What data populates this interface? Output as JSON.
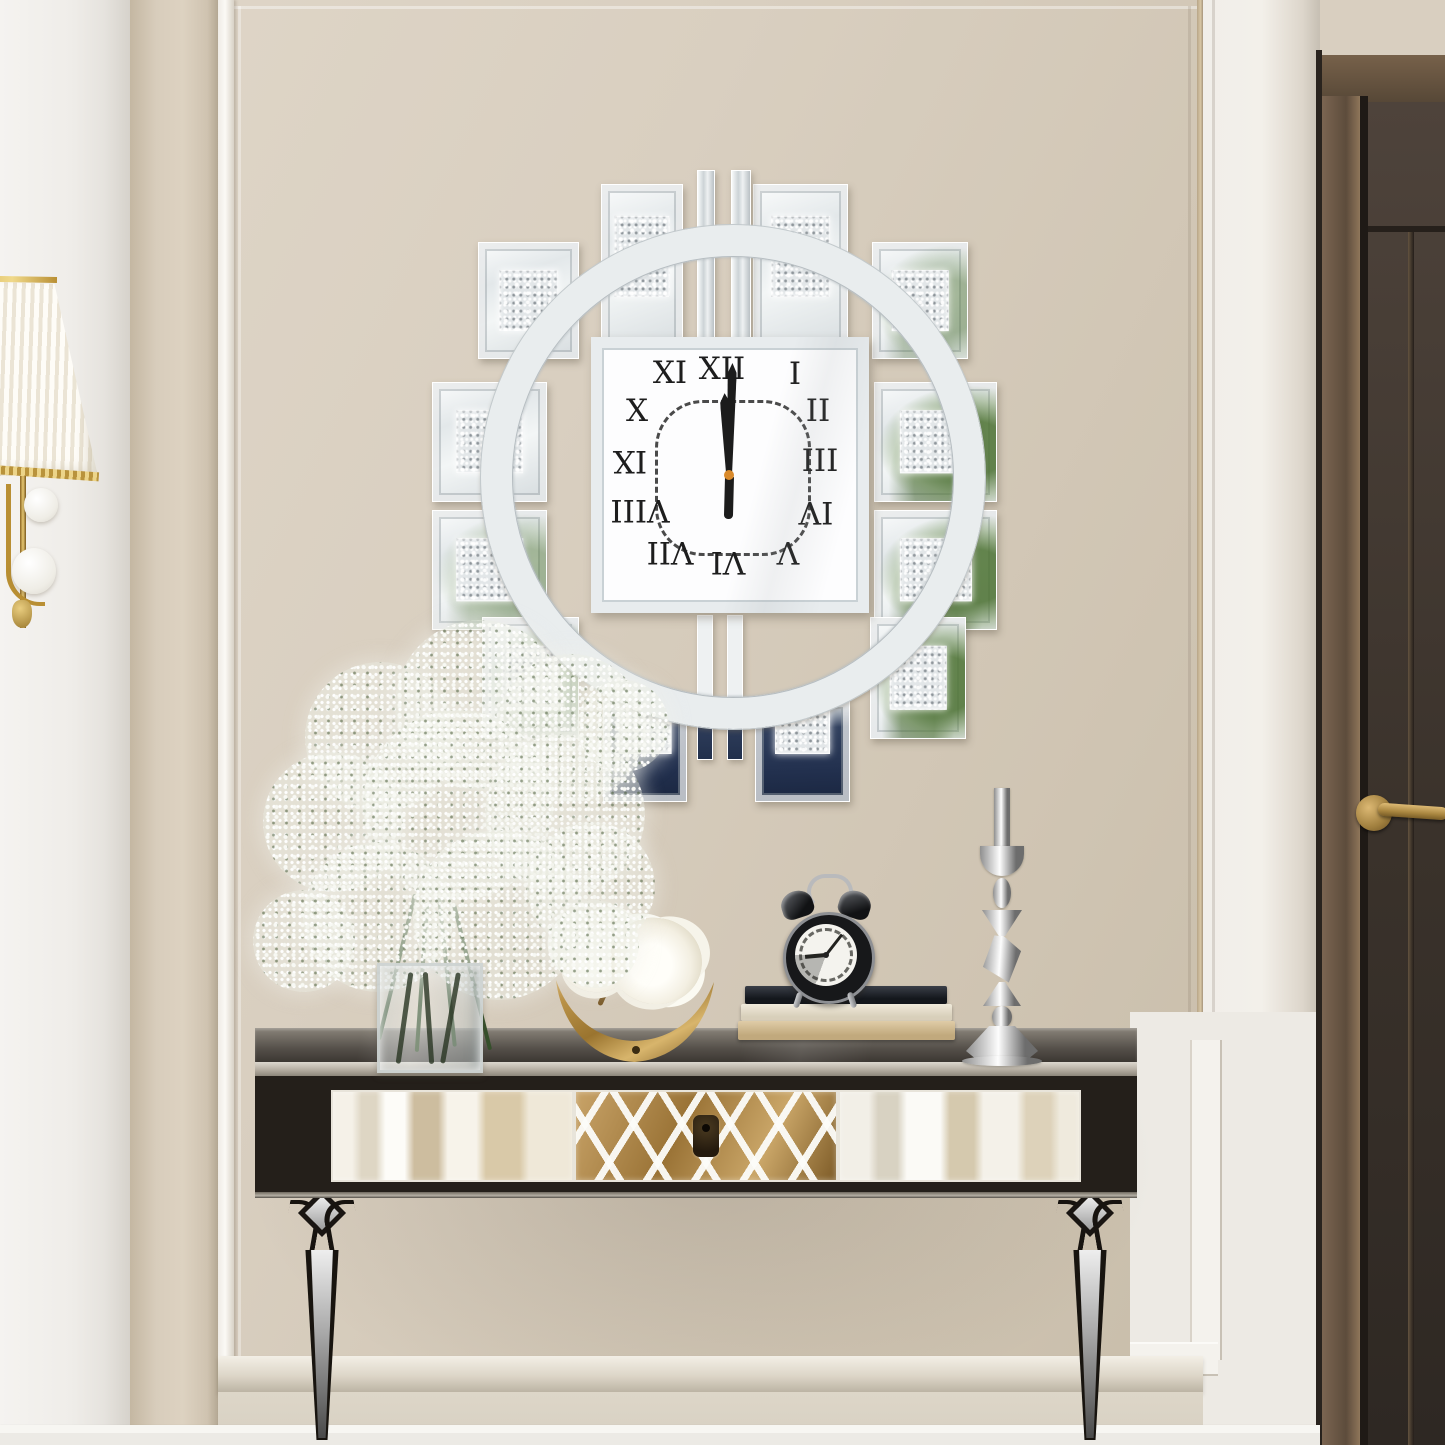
{
  "product": {
    "wall_clock": {
      "time": "12:00",
      "numerals": [
        "XII",
        "I",
        "II",
        "III",
        "IV",
        "V",
        "VI",
        "VII",
        "VIII",
        "IX",
        "X",
        "XI"
      ]
    }
  },
  "decor": {
    "alarm_clock_time": "9:05"
  },
  "colors": {
    "wall_beige": "#d9cfc0",
    "trim_white": "#f3f1ec",
    "mirror_silver": "#e9edee",
    "crystal_fill": "#e2e6e8",
    "door_brown": "#3a322b",
    "handle_gold": "#bf9a55",
    "drawer_gold": "#b08a50",
    "reflection_blue": "#22304e",
    "plant_green": "#5d8743",
    "table_black": "#241f1b"
  }
}
